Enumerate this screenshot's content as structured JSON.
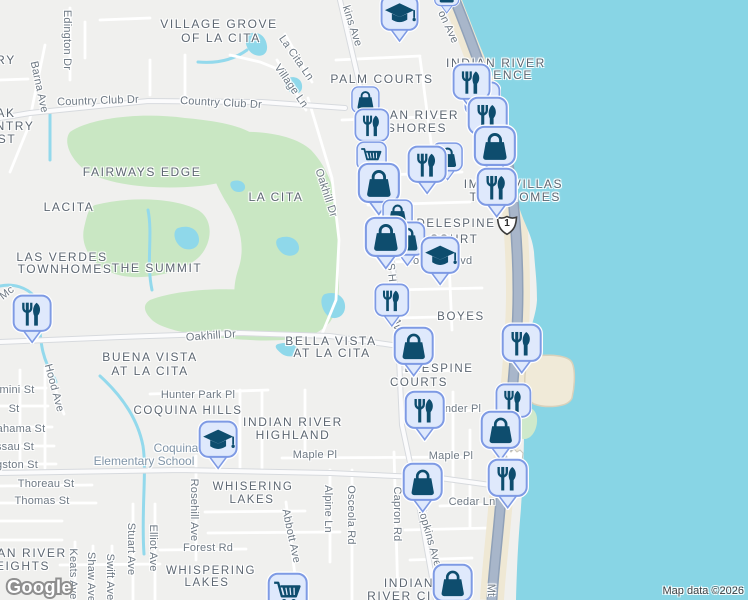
{
  "map": {
    "logo": "Google",
    "attribution": "Map data ©2026",
    "route_shield": "1",
    "labels": [
      {
        "t": "VILLAGE GROVE",
        "x": 219,
        "y": 24,
        "cls": "area",
        "fs": 12
      },
      {
        "t": "OF LA CITA",
        "x": 221,
        "y": 38,
        "cls": "area",
        "fs": 12
      },
      {
        "t": "PALM COURTS",
        "x": 382,
        "y": 79,
        "cls": "area",
        "fs": 12
      },
      {
        "t": "INDIAN RIVER",
        "x": 496,
        "y": 63,
        "cls": "area",
        "fs": 12
      },
      {
        "t": "DENCE",
        "x": 508,
        "y": 75,
        "cls": "area",
        "fs": 12
      },
      {
        "t": "IAN RIVER",
        "x": 422,
        "y": 115,
        "cls": "area",
        "fs": 12
      },
      {
        "t": "SHORES",
        "x": 417,
        "y": 128,
        "cls": "area",
        "fs": 12
      },
      {
        "t": "FAIRWAYS EDGE",
        "x": 142,
        "y": 172,
        "cls": "area",
        "fs": 12
      },
      {
        "t": "LA CITA",
        "x": 276,
        "y": 197,
        "cls": "area",
        "fs": 12
      },
      {
        "t": "LACITA",
        "x": 69,
        "y": 207,
        "cls": "area",
        "fs": 12
      },
      {
        "t": "LAS VERDES",
        "x": 62,
        "y": 257,
        "cls": "area",
        "fs": 12
      },
      {
        "t": "TOWNHOMES",
        "x": 65,
        "y": 269,
        "cls": "area",
        "fs": 12
      },
      {
        "t": "THE SUMMIT",
        "x": 157,
        "y": 268,
        "cls": "area",
        "fs": 12
      },
      {
        "t": "IM",
        "x": 472,
        "y": 184,
        "cls": "area",
        "fs": 12
      },
      {
        "t": "VILLAS",
        "x": 538,
        "y": 184,
        "cls": "area",
        "fs": 12
      },
      {
        "t": "T",
        "x": 474,
        "y": 197,
        "cls": "area",
        "fs": 12
      },
      {
        "t": "HOMES",
        "x": 535,
        "y": 197,
        "cls": "area",
        "fs": 12
      },
      {
        "t": "DELESPINE",
        "x": 456,
        "y": 224,
        "cls": "area"
      },
      {
        "t": "COURT",
        "x": 454,
        "y": 240,
        "cls": "area"
      },
      {
        "t": "BOYES",
        "x": 461,
        "y": 317,
        "cls": "area"
      },
      {
        "t": "BELLA VISTA",
        "x": 331,
        "y": 341,
        "cls": "area",
        "fs": 12
      },
      {
        "t": "AT LA CITA",
        "x": 332,
        "y": 353,
        "cls": "area",
        "fs": 12
      },
      {
        "t": "BUENA VISTA",
        "x": 150,
        "y": 357,
        "cls": "area",
        "fs": 12
      },
      {
        "t": "AT LA CITA",
        "x": 150,
        "y": 371,
        "cls": "area",
        "fs": 12
      },
      {
        "t": "COQUINA HILLS",
        "x": 188,
        "y": 411,
        "cls": "area"
      },
      {
        "t": "INDIAN RIVER",
        "x": 293,
        "y": 422,
        "cls": "area",
        "fs": 12
      },
      {
        "t": "HIGHLAND",
        "x": 293,
        "y": 435,
        "cls": "area",
        "fs": 12
      },
      {
        "t": "WHISERING",
        "x": 253,
        "y": 487,
        "cls": "area"
      },
      {
        "t": "LAKES",
        "x": 252,
        "y": 500,
        "cls": "area"
      },
      {
        "t": "ELESPINE",
        "x": 439,
        "y": 369,
        "cls": "area"
      },
      {
        "t": "COURTS",
        "x": 419,
        "y": 383,
        "cls": "area"
      },
      {
        "t": "WHISPERING",
        "x": 211,
        "y": 571,
        "cls": "area"
      },
      {
        "t": "LAKES",
        "x": 207,
        "y": 583,
        "cls": "area"
      },
      {
        "t": "AN RIVER",
        "x": 32,
        "y": 553,
        "cls": "area",
        "fs": 12
      },
      {
        "t": "EIGHTS",
        "x": 23,
        "y": 566,
        "cls": "area",
        "fs": 12
      },
      {
        "t": "INDIAN",
        "x": 409,
        "y": 583,
        "cls": "area",
        "fs": 12
      },
      {
        "t": "RIVER CIT",
        "x": 404,
        "y": 596,
        "cls": "area",
        "fs": 12
      },
      {
        "t": "RY",
        "x": 6,
        "y": 60,
        "cls": "area",
        "fs": 12
      },
      {
        "t": "AK",
        "x": 6,
        "y": 113,
        "cls": "area",
        "fs": 12
      },
      {
        "t": "NTRY",
        "x": 15,
        "y": 126,
        "cls": "area",
        "fs": 12
      },
      {
        "t": "ST",
        "x": 7,
        "y": 139,
        "cls": "area",
        "fs": 12
      },
      {
        "t": "Edington Dr",
        "x": 67,
        "y": 40,
        "cls": "street",
        "r": 90
      },
      {
        "t": "Barna Ave",
        "x": 39,
        "y": 87,
        "cls": "street",
        "r": 78
      },
      {
        "t": "Country Club Dr",
        "x": 98,
        "y": 101,
        "cls": "street",
        "r": -2
      },
      {
        "t": "Country Club Dr",
        "x": 221,
        "y": 103,
        "cls": "street",
        "r": 3
      },
      {
        "t": "La Cita Ln",
        "x": 296,
        "y": 58,
        "cls": "street",
        "r": 55
      },
      {
        "t": "Village Ln",
        "x": 291,
        "y": 86,
        "cls": "street",
        "r": 55
      },
      {
        "t": "kins Ave",
        "x": 352,
        "y": 26,
        "cls": "street",
        "r": 72
      },
      {
        "t": "on Ave",
        "x": 448,
        "y": 27,
        "cls": "street",
        "r": 65
      },
      {
        "t": "Oakhill Dr",
        "x": 326,
        "y": 193,
        "cls": "street",
        "r": 72
      },
      {
        "t": "Oakhill Dr",
        "x": 211,
        "y": 336,
        "cls": "street",
        "r": -4
      },
      {
        "t": "Mc",
        "x": 7,
        "y": 293,
        "cls": "street",
        "r": -38
      },
      {
        "t": "S Hopkins Ave",
        "x": 394,
        "y": 300,
        "cls": "street",
        "r": 84
      },
      {
        "t": "Hood Ave",
        "x": 54,
        "y": 388,
        "cls": "street",
        "r": 75
      },
      {
        "t": "Hunter Park Pl",
        "x": 198,
        "y": 395,
        "cls": "street"
      },
      {
        "t": "Maple Pl",
        "x": 315,
        "y": 455,
        "cls": "street"
      },
      {
        "t": "Maple Pl",
        "x": 451,
        "y": 456,
        "cls": "street"
      },
      {
        "t": "nder Pl",
        "x": 463,
        "y": 409,
        "cls": "street"
      },
      {
        "t": "Cedar Ln",
        "x": 472,
        "y": 502,
        "cls": "street"
      },
      {
        "t": "Cor",
        "x": 414,
        "y": 261,
        "cls": "street"
      },
      {
        "t": "lvd",
        "x": 465,
        "y": 261,
        "cls": "street"
      },
      {
        "t": "Capron Rd",
        "x": 397,
        "y": 514,
        "cls": "street",
        "r": 90
      },
      {
        "t": "Hopkins Ave",
        "x": 429,
        "y": 536,
        "cls": "street",
        "r": 74
      },
      {
        "t": "Osceola Rd",
        "x": 351,
        "y": 515,
        "cls": "street",
        "r": 90
      },
      {
        "t": "Alpine Ln",
        "x": 328,
        "y": 509,
        "cls": "street",
        "r": 90
      },
      {
        "t": "Abbott Ave",
        "x": 291,
        "y": 536,
        "cls": "street",
        "r": 78
      },
      {
        "t": "Rosehill Ave",
        "x": 194,
        "y": 510,
        "cls": "street",
        "r": 90
      },
      {
        "t": "Thoreau St",
        "x": 46,
        "y": 484,
        "cls": "street"
      },
      {
        "t": "Thomas St",
        "x": 42,
        "y": 501,
        "cls": "street"
      },
      {
        "t": "gston St",
        "x": 17,
        "y": 465,
        "cls": "street"
      },
      {
        "t": "ssau St",
        "x": 15,
        "y": 447,
        "cls": "street"
      },
      {
        "t": "ahama St",
        "x": 21,
        "y": 429,
        "cls": "street"
      },
      {
        "t": "St",
        "x": 14,
        "y": 409,
        "cls": "street"
      },
      {
        "t": "mini St",
        "x": 17,
        "y": 390,
        "cls": "street"
      },
      {
        "t": "Forest Rd",
        "x": 208,
        "y": 548,
        "cls": "street"
      },
      {
        "t": "Keats Ave",
        "x": 73,
        "y": 574,
        "cls": "street",
        "r": 90
      },
      {
        "t": "Shaw Ave",
        "x": 91,
        "y": 577,
        "cls": "street",
        "r": 90
      },
      {
        "t": "Swift Ave",
        "x": 110,
        "y": 577,
        "cls": "street",
        "r": 90
      },
      {
        "t": "Stuart Ave",
        "x": 131,
        "y": 549,
        "cls": "street",
        "r": 90
      },
      {
        "t": "Elliot Ave",
        "x": 153,
        "y": 548,
        "cls": "street",
        "r": 90
      },
      {
        "t": "Mt",
        "x": 491,
        "y": 590,
        "cls": "street",
        "r": 90
      },
      {
        "t": "Coquina",
        "x": 176,
        "y": 448,
        "cls": "poi"
      },
      {
        "t": "Elementary School",
        "x": 144,
        "y": 461,
        "cls": "poi"
      }
    ],
    "markers": [
      {
        "type": "school",
        "x": 400,
        "y": 13,
        "s": 36
      },
      {
        "type": "shopping-bag",
        "x": 447,
        "y": -6,
        "s": 24
      },
      {
        "type": "shopping-bag",
        "x": 365,
        "y": 100,
        "s": 27
      },
      {
        "type": "restaurant",
        "x": 372,
        "y": 125,
        "s": 33
      },
      {
        "type": "shopping-cart",
        "x": 372,
        "y": 156,
        "s": 29
      },
      {
        "type": "shopping-bag",
        "x": 379,
        "y": 183,
        "s": 40
      },
      {
        "type": "restaurant",
        "x": 472,
        "y": 82,
        "s": 36,
        "z": 505
      },
      {
        "type": "shopping-bag",
        "x": 482,
        "y": 99,
        "s": 34
      },
      {
        "type": "restaurant",
        "x": 488,
        "y": 116,
        "s": 38,
        "z": 516
      },
      {
        "type": "shopping-bag",
        "x": 495,
        "y": 146,
        "s": 40
      },
      {
        "type": "restaurant",
        "x": 497,
        "y": 187,
        "s": 38
      },
      {
        "type": "shopping-bag",
        "x": 448,
        "y": 157,
        "s": 29
      },
      {
        "type": "restaurant",
        "x": 427,
        "y": 164,
        "s": 37
      },
      {
        "type": "shopping-bag",
        "x": 398,
        "y": 214,
        "s": 29
      },
      {
        "type": "shopping-bag",
        "x": 407,
        "y": 239,
        "s": 34,
        "z": 633
      },
      {
        "type": "shopping-bag",
        "x": 386,
        "y": 237,
        "s": 40,
        "z": 638
      },
      {
        "type": "school",
        "x": 440,
        "y": 255,
        "s": 37
      },
      {
        "type": "restaurant",
        "x": 392,
        "y": 300,
        "s": 33
      },
      {
        "type": "restaurant",
        "x": 32,
        "y": 313,
        "s": 37
      },
      {
        "type": "school",
        "x": 218,
        "y": 439,
        "s": 37
      },
      {
        "type": "shopping-bag",
        "x": 414,
        "y": 346,
        "s": 38
      },
      {
        "type": "restaurant",
        "x": 425,
        "y": 410,
        "s": 38
      },
      {
        "type": "restaurant",
        "x": 522,
        "y": 343,
        "s": 38
      },
      {
        "type": "restaurant",
        "x": 513,
        "y": 401,
        "s": 34
      },
      {
        "type": "shopping-bag",
        "x": 501,
        "y": 430,
        "s": 38
      },
      {
        "type": "restaurant",
        "x": 508,
        "y": 478,
        "s": 38
      },
      {
        "type": "shopping-bag",
        "x": 423,
        "y": 482,
        "s": 38
      },
      {
        "type": "shopping-bag",
        "x": 453,
        "y": 583,
        "s": 38
      },
      {
        "type": "shopping-cart",
        "x": 288,
        "y": 592,
        "s": 38
      }
    ]
  }
}
